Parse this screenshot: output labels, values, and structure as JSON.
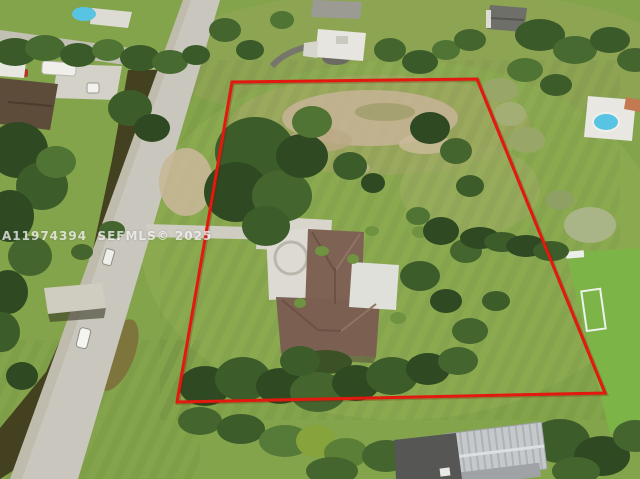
{
  "image": {
    "kind": "aerial-drone-real-estate-photo",
    "subject": "large fenced lot with single-family home, trees and lawn"
  },
  "watermark": {
    "text": "A11974394  SEFMLS© 2025",
    "color": "#ffffff"
  },
  "boundary": {
    "points": "232,82 477,79 605,393 177,402",
    "color": "#e2190e",
    "stroke_width": "3"
  },
  "palette": {
    "grass": "#83a44b",
    "grass_bright": "#7cb447",
    "canal_water": "#43411f",
    "road": "#c9c7bd",
    "concrete": "#dedcd4",
    "roof_brown": "#7e6355",
    "roof_white": "#e0dfd8",
    "warehouse_gray": "#c6c9cb",
    "pool_blue": "#57c4e4",
    "dirt": "#c3b392"
  }
}
